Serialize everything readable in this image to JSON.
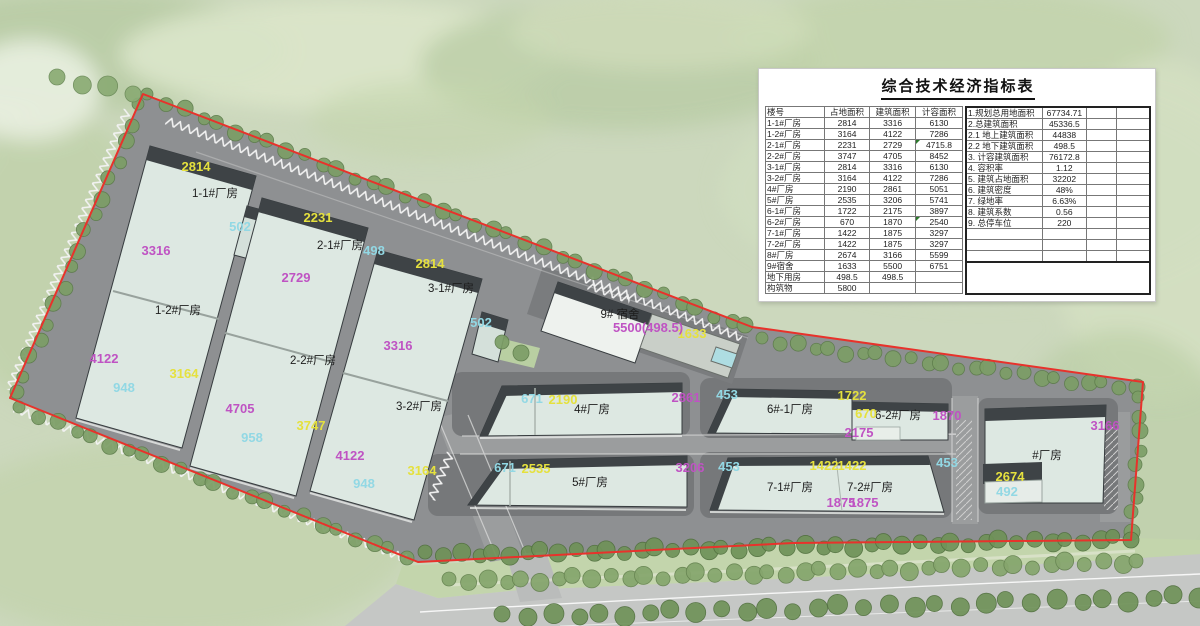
{
  "panel": {
    "title": "综合技术经济指标表",
    "left_table": {
      "headers": [
        "楼号",
        "占地面积",
        "建筑面积",
        "计容面积"
      ],
      "rows": [
        [
          "1-1#厂房",
          "2814",
          "3316",
          "6130"
        ],
        [
          "1-2#厂房",
          "3164",
          "4122",
          "7286"
        ],
        [
          "2-1#厂房",
          "2231",
          "2729",
          "4715.8"
        ],
        [
          "2-2#厂房",
          "3747",
          "4705",
          "8452"
        ],
        [
          "3-1#厂房",
          "2814",
          "3316",
          "6130"
        ],
        [
          "3-2#厂房",
          "3164",
          "4122",
          "7286"
        ],
        [
          "4#厂房",
          "2190",
          "2861",
          "5051"
        ],
        [
          "5#厂房",
          "2535",
          "3206",
          "5741"
        ],
        [
          "6-1#厂房",
          "1722",
          "2175",
          "3897"
        ],
        [
          "6-2#厂房",
          "670",
          "1870",
          "2540"
        ],
        [
          "7-1#厂房",
          "1422",
          "1875",
          "3297"
        ],
        [
          "7-2#厂房",
          "1422",
          "1875",
          "3297"
        ],
        [
          "8#厂房",
          "2674",
          "3166",
          "5599"
        ],
        [
          "9#宿舍",
          "1633",
          "5500",
          "6751"
        ],
        [
          "地下用房",
          "498.5",
          "498.5",
          ""
        ],
        [
          "构筑物",
          "5800",
          "",
          ""
        ]
      ],
      "comment_rows": [
        2,
        9
      ]
    },
    "right_table": {
      "rows": [
        [
          "1.规划总用地面积",
          "67734.71"
        ],
        [
          "2.总建筑面积",
          "45336.5"
        ],
        [
          "2.1 地上建筑面积",
          "44838"
        ],
        [
          "2.2 地下建筑面积",
          "498.5"
        ],
        [
          "3. 计容建筑面积",
          "76172.8"
        ],
        [
          "4. 容积率",
          "1.12"
        ],
        [
          "5. 建筑占地面积",
          "32202"
        ],
        [
          "6. 建筑密度",
          "48%"
        ],
        [
          "7. 绿地率",
          "6.63%"
        ],
        [
          "8. 建筑系数",
          "0.56"
        ],
        [
          "9. 总停车位",
          "220"
        ],
        [
          "",
          ""
        ],
        [
          "",
          ""
        ],
        [
          "",
          ""
        ]
      ]
    }
  },
  "site_plan": {
    "boundary_color": "#e8322b",
    "label_colors": {
      "building_name": "#1d1d1d",
      "footprint_yellow": "#e5e13e",
      "floor_area_magenta": "#bf53c3",
      "annex_cyan": "#92d8e4"
    },
    "labels": [
      {
        "t": "1-1#厂房",
        "x": 215,
        "y": 197,
        "c": "bn"
      },
      {
        "t": "1-2#厂房",
        "x": 178,
        "y": 314,
        "c": "bn"
      },
      {
        "t": "2-1#厂房",
        "x": 340,
        "y": 249,
        "c": "bn"
      },
      {
        "t": "2-2#厂房",
        "x": 313,
        "y": 364,
        "c": "bn"
      },
      {
        "t": "3-1#厂房",
        "x": 451,
        "y": 292,
        "c": "bn"
      },
      {
        "t": "3-2#厂房",
        "x": 419,
        "y": 410,
        "c": "bn"
      },
      {
        "t": "4#厂房",
        "x": 592,
        "y": 413,
        "c": "bn"
      },
      {
        "t": "5#厂房",
        "x": 590,
        "y": 486,
        "c": "bn"
      },
      {
        "t": "6#-1厂房",
        "x": 790,
        "y": 413,
        "c": "bn"
      },
      {
        "t": "6-2#厂房",
        "x": 898,
        "y": 419,
        "c": "bn"
      },
      {
        "t": "7-1#厂房",
        "x": 790,
        "y": 491,
        "c": "bn"
      },
      {
        "t": "7-2#厂房",
        "x": 870,
        "y": 491,
        "c": "bn"
      },
      {
        "t": "#厂房",
        "x": 1047,
        "y": 459,
        "c": "bn"
      },
      {
        "t": "9# 宿舍",
        "x": 620,
        "y": 318,
        "c": "bn"
      },
      {
        "t": "2814",
        "x": 196,
        "y": 171,
        "c": "dy"
      },
      {
        "t": "3164",
        "x": 184,
        "y": 378,
        "c": "dy"
      },
      {
        "t": "2231",
        "x": 318,
        "y": 222,
        "c": "dy"
      },
      {
        "t": "3747",
        "x": 311,
        "y": 430,
        "c": "dy"
      },
      {
        "t": "2814",
        "x": 430,
        "y": 268,
        "c": "dy"
      },
      {
        "t": "3164",
        "x": 422,
        "y": 475,
        "c": "dy"
      },
      {
        "t": "2190",
        "x": 563,
        "y": 404,
        "c": "dy"
      },
      {
        "t": "2535",
        "x": 536,
        "y": 473,
        "c": "dy"
      },
      {
        "t": "1722",
        "x": 852,
        "y": 400,
        "c": "dy"
      },
      {
        "t": "670",
        "x": 866,
        "y": 418,
        "c": "dy"
      },
      {
        "t": "1422",
        "x": 824,
        "y": 470,
        "c": "dy"
      },
      {
        "t": "1422",
        "x": 852,
        "y": 470,
        "c": "dy"
      },
      {
        "t": "2674",
        "x": 1010,
        "y": 481,
        "c": "dy"
      },
      {
        "t": "1633",
        "x": 692,
        "y": 338,
        "c": "dy"
      },
      {
        "t": "3316",
        "x": 156,
        "y": 255,
        "c": "dm"
      },
      {
        "t": "4122",
        "x": 104,
        "y": 363,
        "c": "dm"
      },
      {
        "t": "2729",
        "x": 296,
        "y": 282,
        "c": "dm"
      },
      {
        "t": "4705",
        "x": 240,
        "y": 413,
        "c": "dm"
      },
      {
        "t": "3316",
        "x": 398,
        "y": 350,
        "c": "dm"
      },
      {
        "t": "4122",
        "x": 350,
        "y": 460,
        "c": "dm"
      },
      {
        "t": "2861",
        "x": 686,
        "y": 402,
        "c": "dm"
      },
      {
        "t": "3206",
        "x": 690,
        "y": 472,
        "c": "dm"
      },
      {
        "t": "2175",
        "x": 859,
        "y": 437,
        "c": "dm"
      },
      {
        "t": "1870",
        "x": 947,
        "y": 420,
        "c": "dm"
      },
      {
        "t": "1875",
        "x": 841,
        "y": 507,
        "c": "dm"
      },
      {
        "t": "1875",
        "x": 864,
        "y": 507,
        "c": "dm"
      },
      {
        "t": "3166",
        "x": 1105,
        "y": 430,
        "c": "dm"
      },
      {
        "t": "5500(498.5)",
        "x": 648,
        "y": 332,
        "c": "dm"
      },
      {
        "t": "502",
        "x": 240,
        "y": 231,
        "c": "dc"
      },
      {
        "t": "498",
        "x": 374,
        "y": 255,
        "c": "dc"
      },
      {
        "t": "502",
        "x": 481,
        "y": 327,
        "c": "dc"
      },
      {
        "t": "948",
        "x": 124,
        "y": 392,
        "c": "dc"
      },
      {
        "t": "958",
        "x": 252,
        "y": 442,
        "c": "dc"
      },
      {
        "t": "948",
        "x": 364,
        "y": 488,
        "c": "dc"
      },
      {
        "t": "671",
        "x": 532,
        "y": 403,
        "c": "dc"
      },
      {
        "t": "671",
        "x": 505,
        "y": 472,
        "c": "dc"
      },
      {
        "t": "453",
        "x": 727,
        "y": 399,
        "c": "dc"
      },
      {
        "t": "453",
        "x": 729,
        "y": 471,
        "c": "dc"
      },
      {
        "t": "453",
        "x": 947,
        "y": 467,
        "c": "dc"
      },
      {
        "t": "492",
        "x": 1007,
        "y": 496,
        "c": "dc"
      }
    ]
  }
}
